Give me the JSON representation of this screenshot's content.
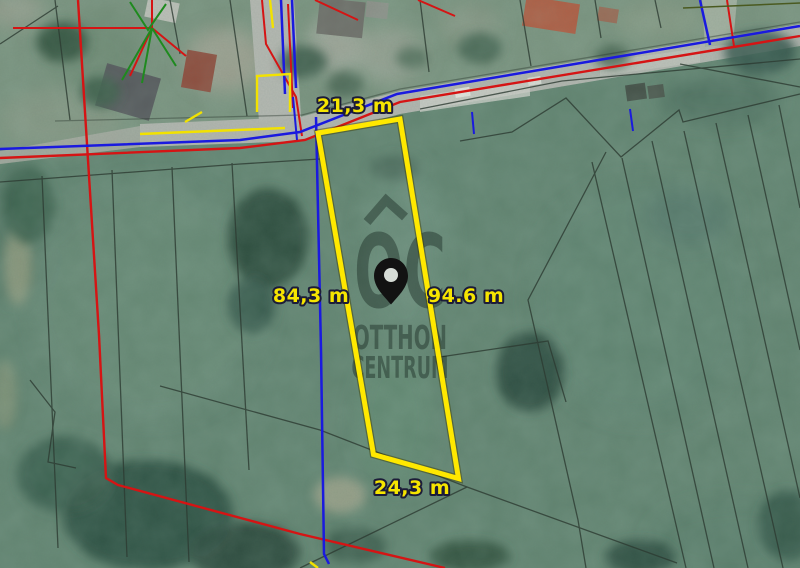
{
  "image": {
    "type": "aerial-cadastral-map",
    "measurements": {
      "top": "21,3 m",
      "left": "84,3 m",
      "right": "94.6 m",
      "bottom": "24,3 m"
    },
    "watermark": {
      "monogram": "OC",
      "line1": "OTTHON",
      "line2": "CENTRUM"
    },
    "icons": {
      "pin": "location-pin",
      "roof": "roof-monogram"
    },
    "colors": {
      "plot_outline": "#ffe800",
      "label_fill": "#f6e500",
      "label_outline": "#1c1c38",
      "cadastral_red": "#d51414",
      "cadastral_blue": "#1a1adf",
      "cadastral_yellow": "#f2e200",
      "cadastral_green": "#1e8a1e",
      "parcel_line": "#2d3b32"
    }
  }
}
